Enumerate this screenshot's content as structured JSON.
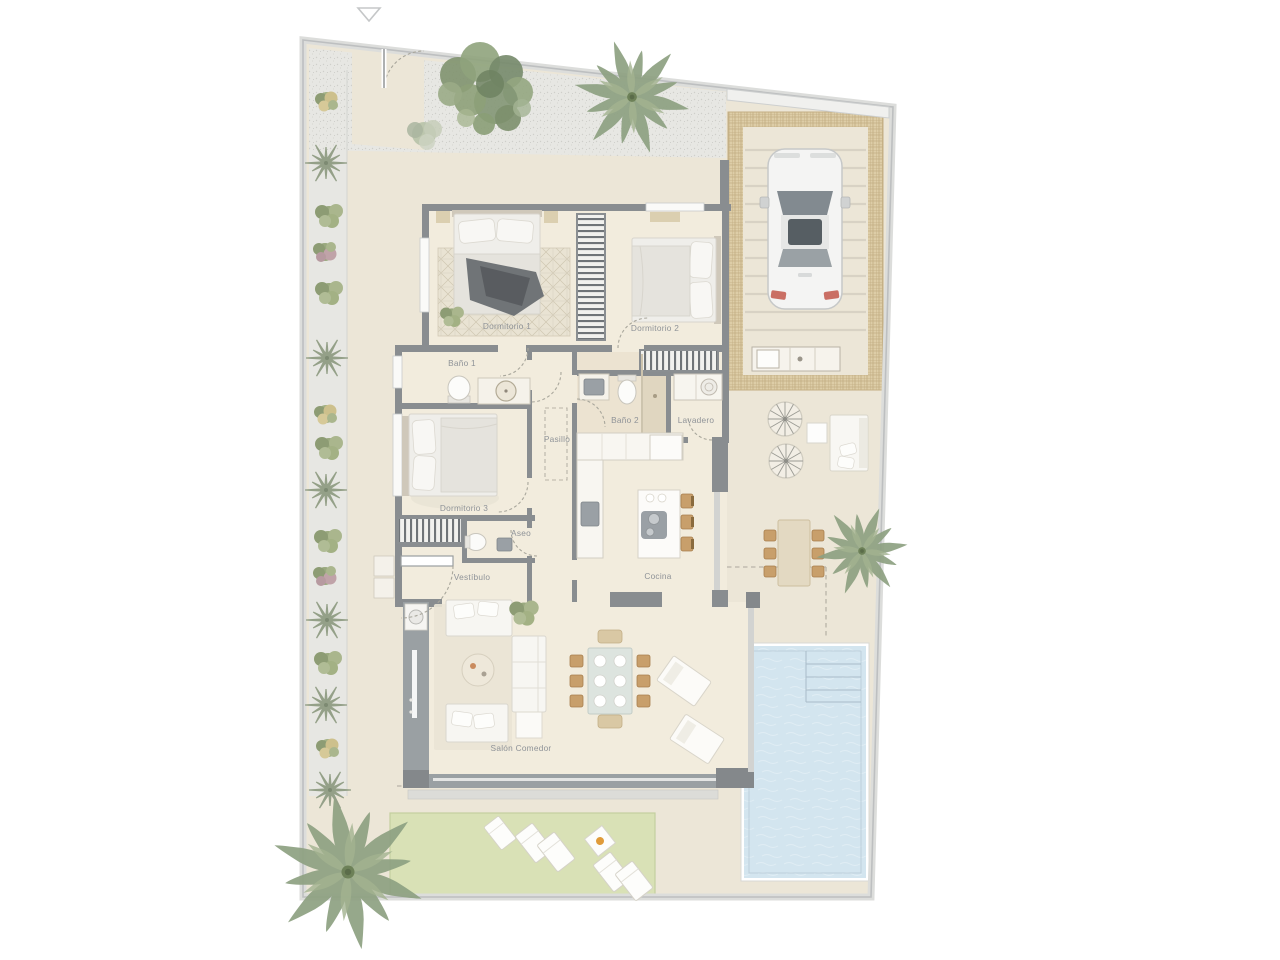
{
  "plan": {
    "kind": "residential villa floor plan, top view",
    "north_marker": "down-triangle-outline"
  },
  "rooms": [
    {
      "id": "dormitorio-1",
      "label": "Dormitorio 1"
    },
    {
      "id": "dormitorio-2",
      "label": "Dormitorio 2"
    },
    {
      "id": "bano-1",
      "label": "Baño 1"
    },
    {
      "id": "bano-2",
      "label": "Baño 2"
    },
    {
      "id": "lavadero",
      "label": "Lavadero"
    },
    {
      "id": "pasillo",
      "label": "Pasillo"
    },
    {
      "id": "dormitorio-3",
      "label": "Dormitorio 3"
    },
    {
      "id": "aseo",
      "label": "Aseo"
    },
    {
      "id": "vestibulo",
      "label": "Vestíbulo"
    },
    {
      "id": "cocina",
      "label": "Cocina"
    },
    {
      "id": "salon-comedor",
      "label": "Salón Comedor"
    }
  ],
  "outdoor_features": [
    {
      "id": "pool",
      "label": ""
    },
    {
      "id": "lawn",
      "label": ""
    },
    {
      "id": "carport-pergola",
      "label": ""
    },
    {
      "id": "car",
      "label": ""
    },
    {
      "id": "palm-trees",
      "label": ""
    }
  ],
  "colors": {
    "background": "#ffffff",
    "terrace": "#ece6d7",
    "floor": "#f2ecdd",
    "wall": "#898d90",
    "wall_light": "#9aa0a3",
    "boundary": "#c6c8c9",
    "pool_water": "#d3e5ef",
    "lawn": "#d9e1b6",
    "pergola": "#ddcda7",
    "gravel": "#e7e7e3",
    "plant": "#8ea182",
    "label_text": "#8f9398",
    "furniture": "#f8f6f1",
    "wood": "#c89f6b",
    "accent_orange": "#e09b3a",
    "car_tail": "#c2574a"
  }
}
